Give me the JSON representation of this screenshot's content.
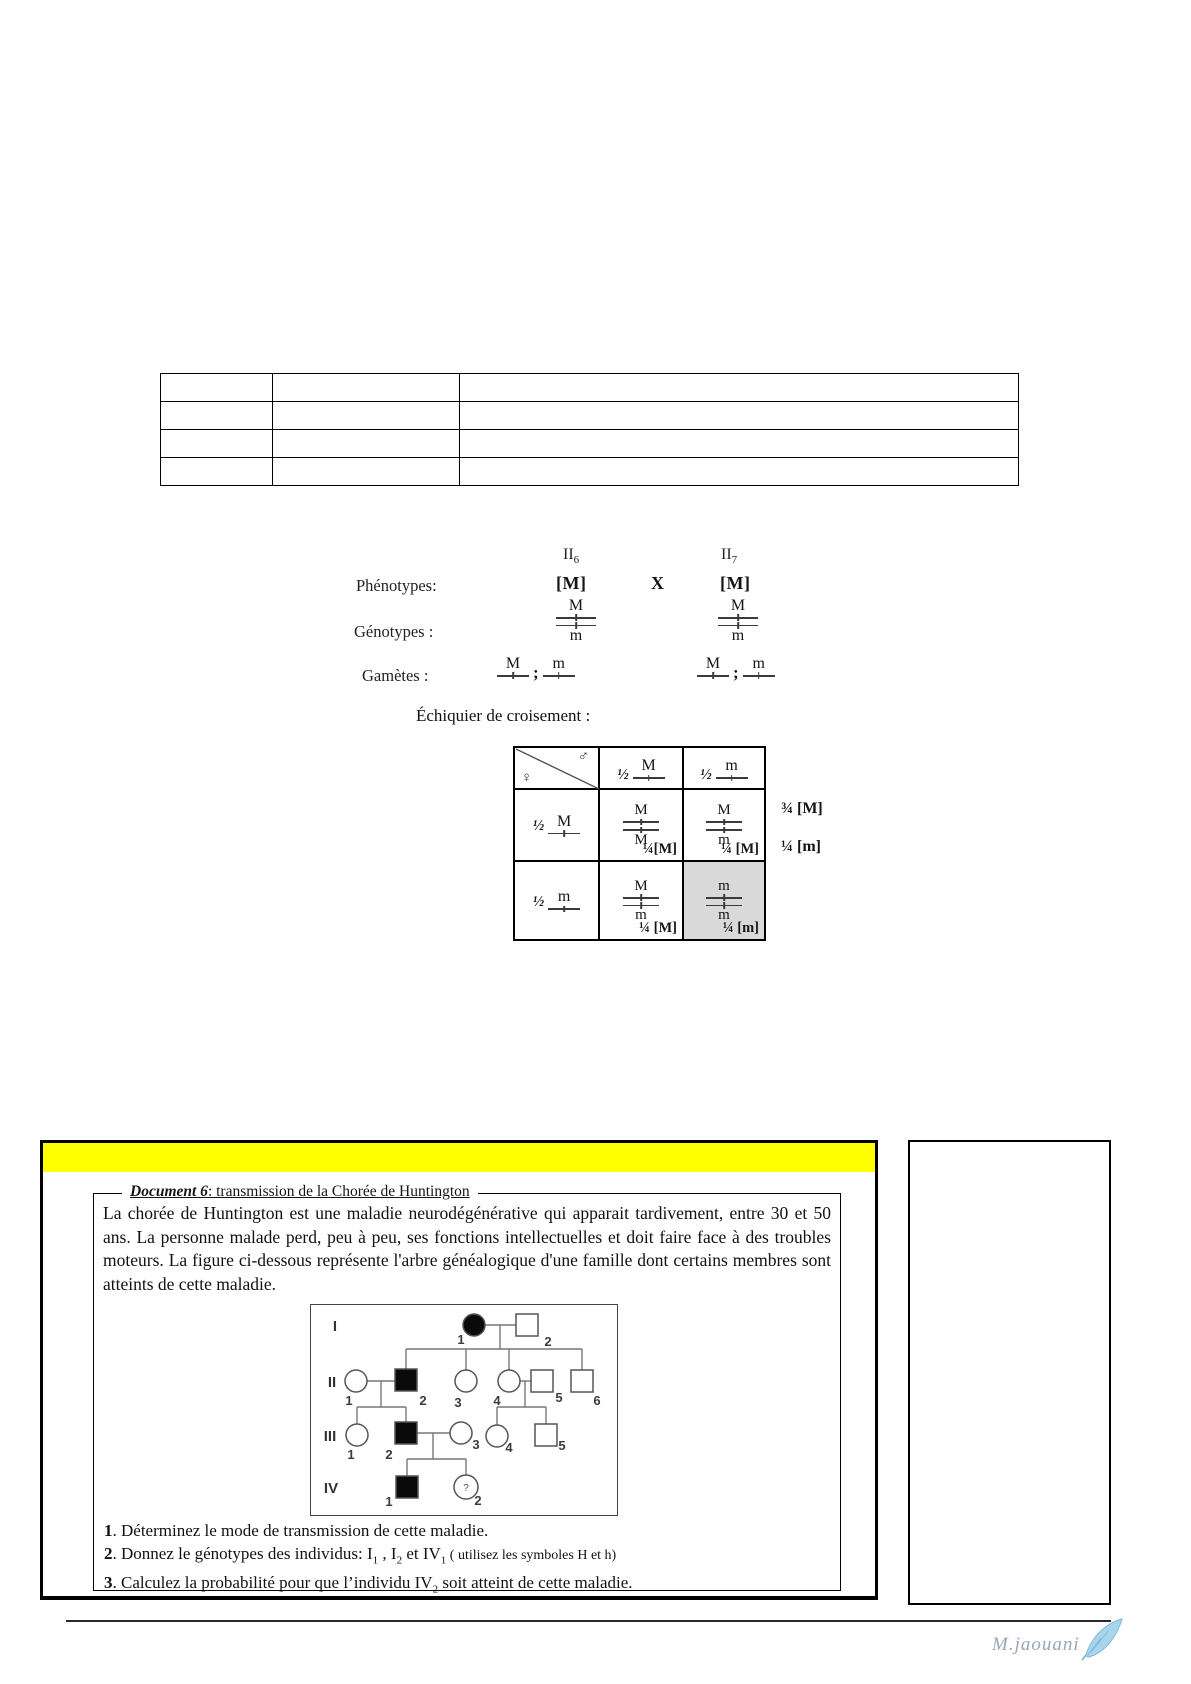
{
  "cross": {
    "parents": [
      {
        "gen": "II",
        "num": "6"
      },
      {
        "gen": "II",
        "num": "7"
      }
    ],
    "rows": {
      "phenotypes": "Phénotypes:",
      "genotypes": "Génotypes :",
      "gametes": "Gamètes :"
    },
    "phenotype_left": "[M]",
    "cross_symbol": "X",
    "phenotype_right": "[M]",
    "genotype_left": {
      "top": "M",
      "bottom": "m"
    },
    "genotype_right": {
      "top": "M",
      "bottom": "m"
    },
    "gametes_left": {
      "a": "M",
      "sep": ";",
      "b": "m"
    },
    "gametes_right": {
      "a": "M",
      "sep": ";",
      "b": "m"
    }
  },
  "punnett": {
    "title": "Échiquier de croisement :",
    "female": "♀",
    "male": "♂",
    "col_headers": [
      {
        "frac": "½",
        "allele": "M"
      },
      {
        "frac": "½",
        "allele": "m"
      }
    ],
    "row_headers": [
      {
        "frac": "½",
        "allele": "M"
      },
      {
        "frac": "½",
        "allele": "m"
      }
    ],
    "cells": [
      {
        "top": "M",
        "bottom": "M",
        "result": "¼[M]"
      },
      {
        "top": "M",
        "bottom": "m",
        "result": "¼ [M]"
      },
      {
        "top": "M",
        "bottom": "m",
        "result": "¼ [M]"
      },
      {
        "top": "m",
        "bottom": "m",
        "result": "¼ [m]"
      }
    ],
    "totals": [
      "¾ [M]",
      "¼ [m]"
    ],
    "shaded_cell_color": "#d9d9d9"
  },
  "document6": {
    "highlight_color": "#ffff00",
    "title_bold": "Document 6",
    "title_rest": ": transmission de la Chorée de Huntington",
    "paragraph": "La chorée de Huntington est une maladie neurodégénérative qui apparait tardivement, entre 30 et 50 ans. La personne malade perd, peu à peu, ses fonctions intellectuelles et doit faire face à des troubles moteurs. La figure ci-dessous représente l'arbre généalogique d'une famille dont certains membres sont atteints de cette maladie.",
    "pedigree": {
      "gen_labels": [
        "I",
        "II",
        "III",
        "IV"
      ],
      "unknown_mark": "?",
      "members": [
        {
          "id": "I-1",
          "sex": "F",
          "affected": true,
          "label": "1"
        },
        {
          "id": "I-2",
          "sex": "M",
          "affected": false,
          "label": "2"
        },
        {
          "id": "II-1",
          "sex": "F",
          "affected": false,
          "label": "1"
        },
        {
          "id": "II-2",
          "sex": "M",
          "affected": true,
          "label": "2"
        },
        {
          "id": "II-3",
          "sex": "F",
          "affected": false,
          "label": "3"
        },
        {
          "id": "II-4",
          "sex": "F",
          "affected": false,
          "label": "4"
        },
        {
          "id": "II-5",
          "sex": "M",
          "affected": false,
          "label": "5"
        },
        {
          "id": "II-6",
          "sex": "M",
          "affected": false,
          "label": "6"
        },
        {
          "id": "III-1",
          "sex": "F",
          "affected": false,
          "label": "1"
        },
        {
          "id": "III-2",
          "sex": "M",
          "affected": true,
          "label": "2"
        },
        {
          "id": "III-3",
          "sex": "F",
          "affected": false,
          "label": "3"
        },
        {
          "id": "III-4",
          "sex": "F",
          "affected": false,
          "label": "4"
        },
        {
          "id": "III-5",
          "sex": "M",
          "affected": false,
          "label": "5"
        },
        {
          "id": "IV-1",
          "sex": "M",
          "affected": true,
          "label": "1"
        },
        {
          "id": "IV-2",
          "sex": "F",
          "affected": false,
          "unknown": true,
          "label": "2"
        }
      ]
    },
    "questions": {
      "q1": {
        "num": "1",
        "text": ". Déterminez le mode de transmission de cette maladie."
      },
      "q2": {
        "num": "2",
        "p1": ". Donnez le génotypes des individus: I",
        "s1": "1",
        "p2": " , I",
        "s2": "2",
        "p3": " et IV",
        "s3": "1",
        "note": " ( utilisez les symboles H et h)"
      },
      "q3": {
        "num": "3",
        "p1": ". Calculez la probabilité pour que l’individu IV",
        "s1": "2",
        "p2": " soit atteint de cette maladie."
      }
    }
  },
  "signature": {
    "name": "M.jaouani"
  }
}
